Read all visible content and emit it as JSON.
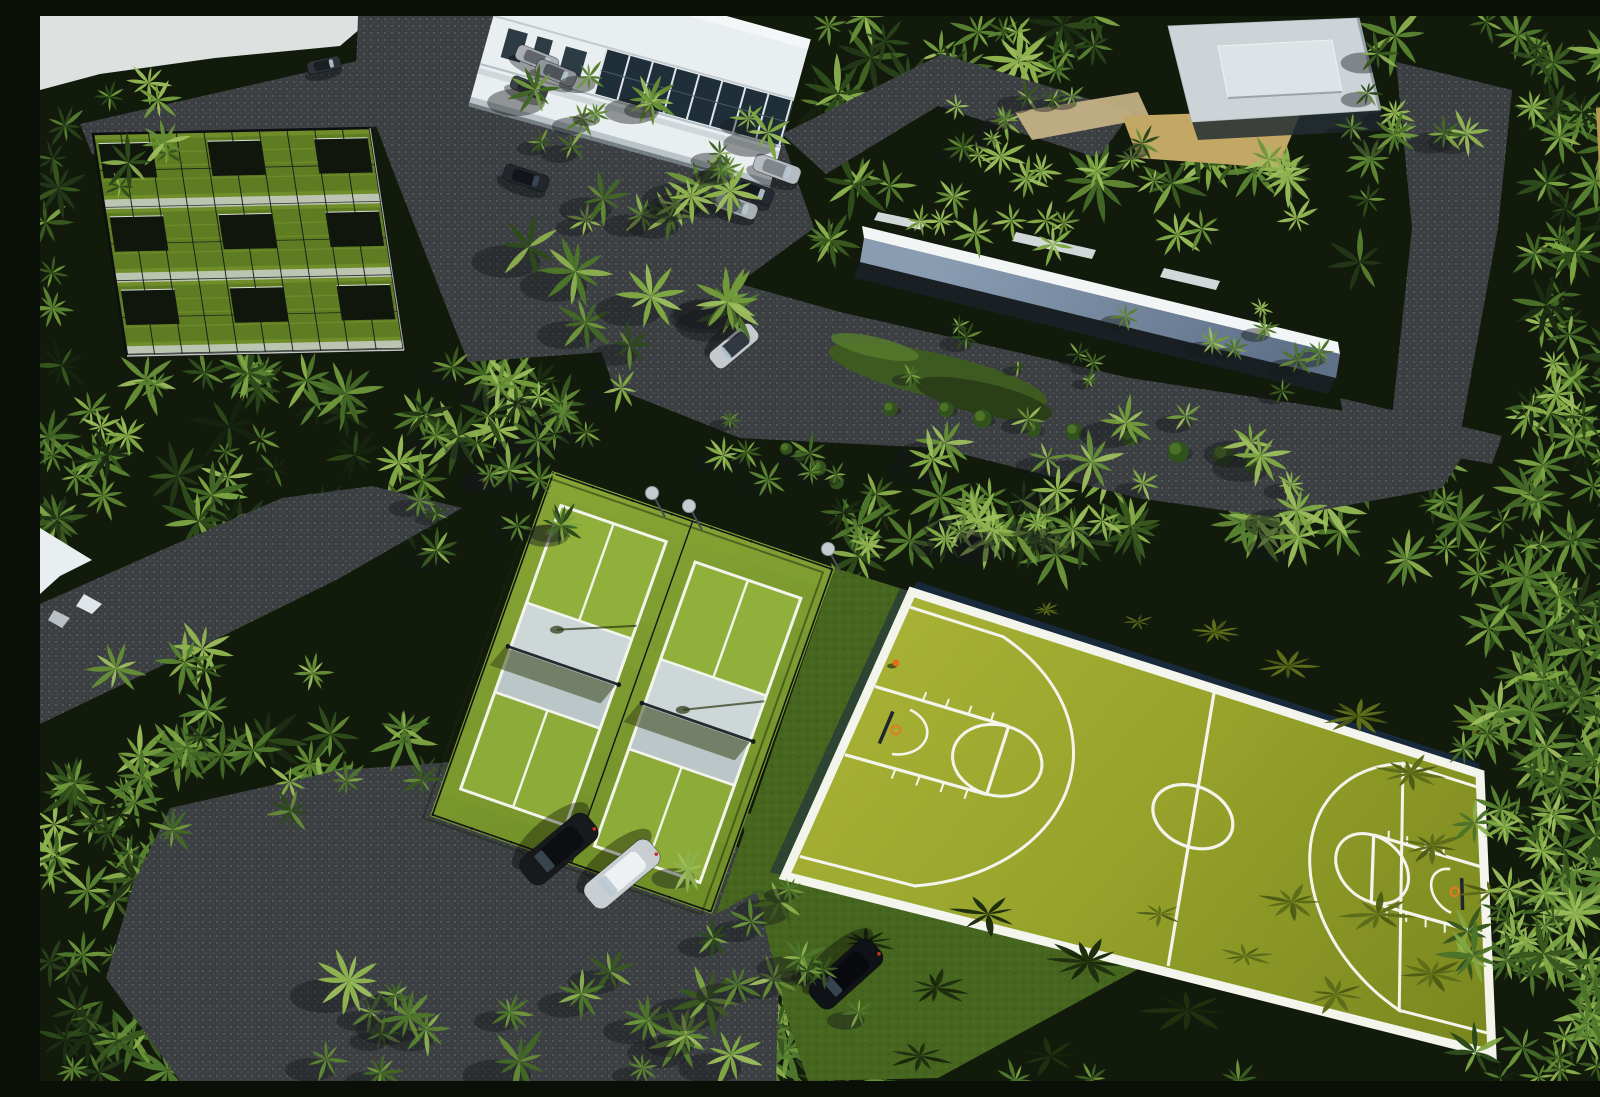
{
  "meta": {
    "description": "Sunny aerial photograph of a tropical resort sports complex: dense palm groves, two fenced pickleball courts, a large green basketball court, netted practice bays, white buildings, a white privacy wall, gray asphalt roads and parked cars",
    "setting": "daytime aerial view"
  },
  "palette": {
    "background": "#111a0b",
    "road": "#3b3f42",
    "road_speckle": "#85898c",
    "sky_glare": "#dde2e1",
    "court_green_light": "#a6b135",
    "court_green": "#96a22a",
    "court_green_deep": "#7b881f",
    "court_line": "#f3f5ed",
    "windscreen": "#1a2a41",
    "turf_light": "#86a435",
    "turf": "#6f8e27",
    "kitchen_gray": "#bac6c8",
    "kitchen_gray_light": "#cdd7d7",
    "pickle_court": "#8cab38",
    "fence": "#111417",
    "cage_turf": "#6f8d28",
    "cage_dark_row": "#5a7820",
    "cage_bay": "#11160c",
    "cage_walk": "#c9cfc9",
    "wall_top": "#f2f5f6",
    "wall_face_hi": "#8a9cb2",
    "wall_face_lo": "#5f7188",
    "roof_white": "#e9eef0",
    "pavilion_roof": "#ccd4d8",
    "pavilion_raised": "#dde3e6",
    "glass": "#1f2f3a",
    "sand": "#c2a765",
    "sand_light": "#c9b488",
    "sand_dry": "#b49a52",
    "lawn": "#46651f",
    "island": "#3d5a21",
    "shadow_green": "#5e6d1a",
    "shadow_dark": "#20300f",
    "hoop_orange": "#df7b25",
    "person_orange": "#e8681c",
    "taillight_red": "#c23322"
  },
  "canopy": {
    "dark": [
      "#15220e",
      "#1b2c12",
      "#223617",
      "#28401a"
    ],
    "mid": [
      "#2d4a1a",
      "#38581f",
      "#426625",
      "#4d742b",
      "#577f30"
    ],
    "light": [
      "#648b36",
      "#71993c",
      "#7ea643",
      "#8cb14e"
    ],
    "accent_light": "#9dbf5e",
    "base_attempts": 1500,
    "radius": [
      15,
      37
    ],
    "avoid": [
      [
        388,
        428,
        410,
        480
      ],
      [
        840,
        545,
        625,
        515
      ],
      [
        30,
        80,
        345,
        275
      ],
      [
        310,
        0,
        470,
        350
      ],
      [
        795,
        170,
        520,
        195
      ],
      [
        1085,
        0,
        265,
        120
      ],
      [
        0,
        530,
        440,
        185
      ],
      [
        1340,
        28,
        145,
        400
      ],
      [
        545,
        285,
        810,
        170
      ],
      [
        0,
        0,
        345,
        80
      ],
      [
        968,
        70,
        150,
        60
      ],
      [
        740,
        95,
        370,
        70
      ]
    ],
    "clusters": [
      [
        1422,
        552,
        178,
        513,
        55,
        16,
        38,
        "mid",
        false
      ],
      [
        478,
        168,
        235,
        170,
        15,
        16,
        34,
        "mid",
        true
      ],
      [
        470,
        48,
        300,
        110,
        13,
        13,
        28,
        "mid",
        true
      ],
      [
        820,
        138,
        480,
        92,
        20,
        13,
        26,
        "light",
        false
      ],
      [
        808,
        292,
        500,
        88,
        15,
        9,
        18,
        "mid",
        true
      ],
      [
        348,
        326,
        250,
        150,
        13,
        13,
        28,
        "mid",
        true
      ],
      [
        60,
        628,
        330,
        190,
        16,
        16,
        34,
        "mid",
        false
      ],
      [
        240,
        952,
        580,
        113,
        20,
        16,
        34,
        "mid",
        true
      ],
      [
        630,
        830,
        160,
        140,
        9,
        13,
        26,
        "mid",
        true
      ],
      [
        1302,
        26,
        130,
        95,
        8,
        12,
        24,
        "mid",
        true
      ],
      [
        1452,
        372,
        148,
        210,
        11,
        14,
        28,
        "mid",
        false
      ],
      [
        888,
        78,
        220,
        72,
        9,
        11,
        22,
        "mid",
        true
      ],
      [
        830,
        398,
        430,
        130,
        24,
        14,
        30,
        "light",
        true
      ],
      [
        372,
        430,
        150,
        120,
        8,
        12,
        24,
        "mid",
        true
      ],
      [
        652,
        388,
        150,
        86,
        7,
        11,
        20,
        "mid",
        true
      ],
      [
        0,
        60,
        130,
        130,
        7,
        14,
        28,
        "mid",
        false
      ]
    ]
  },
  "sky": [
    [
      0,
      0
    ],
    [
      335,
      0
    ],
    [
      300,
      30
    ],
    [
      175,
      42
    ],
    [
      60,
      58
    ],
    [
      0,
      74
    ]
  ],
  "roads": [
    [
      [
        40,
        108
      ],
      [
        330,
        42
      ],
      [
        425,
        58
      ],
      [
        432,
        92
      ],
      [
        120,
        152
      ],
      [
        52,
        138
      ]
    ],
    [
      [
        318,
        0
      ],
      [
        562,
        0
      ],
      [
        548,
        58
      ],
      [
        742,
        122
      ],
      [
        774,
        212
      ],
      [
        700,
        266
      ],
      [
        565,
        336
      ],
      [
        428,
        346
      ],
      [
        352,
        152
      ],
      [
        316,
        56
      ]
    ],
    [
      [
        560,
        332
      ],
      [
        700,
        268
      ],
      [
        800,
        296
      ],
      [
        1090,
        362
      ],
      [
        1312,
        396
      ],
      [
        1432,
        426
      ],
      [
        1402,
        472
      ],
      [
        1238,
        502
      ],
      [
        1098,
        482
      ],
      [
        898,
        432
      ],
      [
        700,
        422
      ],
      [
        574,
        372
      ]
    ],
    [
      [
        0,
        588
      ],
      [
        108,
        540
      ],
      [
        242,
        482
      ],
      [
        332,
        470
      ],
      [
        422,
        492
      ],
      [
        300,
        562
      ],
      [
        138,
        642
      ],
      [
        0,
        708
      ]
    ],
    [
      [
        130,
        792
      ],
      [
        300,
        754
      ],
      [
        472,
        742
      ],
      [
        642,
        790
      ],
      [
        742,
        864
      ],
      [
        736,
        1065
      ],
      [
        140,
        1065
      ],
      [
        66,
        962
      ],
      [
        94,
        866
      ]
    ],
    [
      [
        1356,
        46
      ],
      [
        1472,
        74
      ],
      [
        1458,
        212
      ],
      [
        1420,
        420
      ],
      [
        1350,
        420
      ],
      [
        1372,
        212
      ]
    ],
    [
      [
        742,
        118
      ],
      [
        902,
        38
      ],
      [
        1092,
        96
      ],
      [
        1058,
        142
      ],
      [
        898,
        90
      ],
      [
        786,
        158
      ]
    ],
    [
      [
        1300,
        382
      ],
      [
        1462,
        420
      ],
      [
        1452,
        448
      ],
      [
        1308,
        422
      ]
    ]
  ],
  "sand": [
    [
      [
        975,
        96
      ],
      [
        1098,
        76
      ],
      [
        1110,
        102
      ],
      [
        992,
        124
      ]
    ],
    [
      [
        1082,
        100
      ],
      [
        1262,
        94
      ],
      [
        1238,
        152
      ],
      [
        1098,
        142
      ]
    ],
    [
      [
        1556,
        92
      ],
      [
        1600,
        84
      ],
      [
        1600,
        338
      ],
      [
        1566,
        300
      ]
    ]
  ],
  "lawns": [
    [
      [
        700,
        795
      ],
      [
        930,
        862
      ],
      [
        1126,
        938
      ],
      [
        898,
        1062
      ],
      [
        768,
        1065
      ],
      [
        744,
        992
      ],
      [
        718,
        880
      ]
    ],
    [
      [
        795,
        552
      ],
      [
        872,
        576
      ],
      [
        745,
        860
      ],
      [
        676,
        898
      ]
    ]
  ],
  "island": {
    "cx": 898,
    "cy": 360,
    "rx": 112,
    "ry": 22,
    "rot": 13
  },
  "shrub_rows": [
    [
      852,
      388,
      1222,
      448,
      9,
      7,
      12
    ],
    [
      742,
      436,
      800,
      462,
      4,
      6,
      9
    ]
  ],
  "cages": {
    "corners": [
      [
        53,
        118
      ],
      [
        330,
        112
      ],
      [
        364,
        334
      ],
      [
        87,
        340
      ]
    ],
    "w": 280,
    "h": 230
  },
  "pickleball": {
    "corners": [
      [
        512,
        455
      ],
      [
        795,
        552
      ],
      [
        672,
        898
      ],
      [
        390,
        800
      ]
    ],
    "w": 300,
    "h": 370,
    "courts": [
      [
        20,
        30
      ],
      [
        166,
        40
      ]
    ],
    "court_w": 112,
    "court_h": 304
  },
  "basketball": {
    "corners": [
      [
        872,
        576
      ],
      [
        1440,
        758
      ],
      [
        1452,
        1038
      ],
      [
        745,
        860
      ]
    ],
    "w": 600,
    "h": 280
  },
  "wall": {
    "top": [
      [
        822,
        210
      ],
      [
        1298,
        326
      ],
      [
        1300,
        338
      ],
      [
        824,
        222
      ]
    ],
    "face": [
      [
        824,
        222
      ],
      [
        1300,
        338
      ],
      [
        1296,
        362
      ],
      [
        820,
        246
      ]
    ],
    "base": [
      [
        820,
        246
      ],
      [
        1296,
        362
      ],
      [
        1288,
        378
      ],
      [
        814,
        262
      ]
    ],
    "glints": [
      [
        [
          838,
          196
        ],
        [
          886,
          206
        ],
        [
          882,
          214
        ],
        [
          834,
          204
        ]
      ],
      [
        [
          976,
          216
        ],
        [
          1056,
          234
        ],
        [
          1052,
          243
        ],
        [
          972,
          225
        ]
      ],
      [
        [
          1124,
          252
        ],
        [
          1180,
          265
        ],
        [
          1176,
          274
        ],
        [
          1120,
          261
        ]
      ]
    ]
  },
  "pavilion": {
    "roof": [
      [
        1128,
        10
      ],
      [
        1318,
        2
      ],
      [
        1340,
        94
      ],
      [
        1152,
        106
      ]
    ],
    "raised": [
      [
        1178,
        30
      ],
      [
        1292,
        24
      ],
      [
        1302,
        76
      ],
      [
        1188,
        82
      ]
    ],
    "eave": [
      [
        1152,
        106
      ],
      [
        1340,
        94
      ],
      [
        1346,
        114
      ],
      [
        1158,
        124
      ]
    ]
  },
  "condo": {
    "x": 470,
    "y": -60,
    "rot": 15.5,
    "w": 312,
    "h": 152
  },
  "left_roof": [
    [
      0,
      512
    ],
    [
      52,
      544
    ],
    [
      20,
      560
    ],
    [
      0,
      578
    ]
  ],
  "left_roof_bits": [
    [
      [
        44,
        578
      ],
      [
        62,
        588
      ],
      [
        52,
        598
      ],
      [
        36,
        590
      ]
    ],
    [
      [
        14,
        594
      ],
      [
        30,
        602
      ],
      [
        22,
        612
      ],
      [
        8,
        604
      ]
    ]
  ],
  "cars": [
    [
      497,
      43,
      22,
      44,
      16,
      "#a8aeb3",
      "#61666b"
    ],
    [
      516,
      57,
      22,
      42,
      16,
      "#8f969b",
      "#4f545a"
    ],
    [
      489,
      72,
      22,
      38,
      14,
      "#3a4046",
      "#23272c"
    ],
    [
      486,
      162,
      18,
      46,
      17,
      "#22272e",
      "#121519"
    ],
    [
      737,
      153,
      20,
      48,
      18,
      "#b6bcc1",
      "#7f868c"
    ],
    [
      712,
      175,
      20,
      44,
      17,
      "#262b33",
      "#14181e"
    ],
    [
      696,
      190,
      20,
      44,
      16,
      "#a9b0b5",
      "#767d83"
    ],
    [
      694,
      330,
      140,
      54,
      21,
      "#c3c9cd",
      "#32383f"
    ],
    [
      519,
      833,
      140,
      86,
      33,
      "#17191d",
      "#0c0e11"
    ],
    [
      582,
      858,
      140,
      84,
      31,
      "#c9ced2",
      "#eef1f3"
    ],
    [
      806,
      958,
      138,
      82,
      32,
      "#0f1217",
      "#080a0d"
    ],
    [
      284,
      49,
      -12,
      34,
      13,
      "#2e3338",
      "#1b1f24"
    ]
  ],
  "light_poles": [
    [
      612,
      477
    ],
    [
      649,
      490
    ],
    [
      788,
      533
    ]
  ],
  "person": [
    856,
    647
  ],
  "court_shadows": [
    [
      1175,
      616,
      22
    ],
    [
      1248,
      650,
      28
    ],
    [
      1318,
      700,
      33
    ],
    [
      1370,
      757,
      31
    ],
    [
      1392,
      830,
      33
    ],
    [
      1338,
      898,
      37
    ],
    [
      1252,
      886,
      30
    ],
    [
      1392,
      958,
      30
    ],
    [
      1296,
      978,
      33
    ],
    [
      1098,
      606,
      17
    ],
    [
      1006,
      594,
      14
    ],
    [
      1438,
      706,
      26
    ],
    [
      1450,
      876,
      28
    ],
    [
      1120,
      898,
      22
    ],
    [
      1205,
      940,
      26
    ]
  ],
  "lawn_shadows": [
    [
      948,
      898,
      36
    ],
    [
      1048,
      946,
      40
    ],
    [
      1148,
      994,
      42
    ],
    [
      896,
      972,
      34
    ],
    [
      826,
      926,
      28
    ],
    [
      1010,
      1040,
      36
    ],
    [
      880,
      1040,
      30
    ]
  ]
}
